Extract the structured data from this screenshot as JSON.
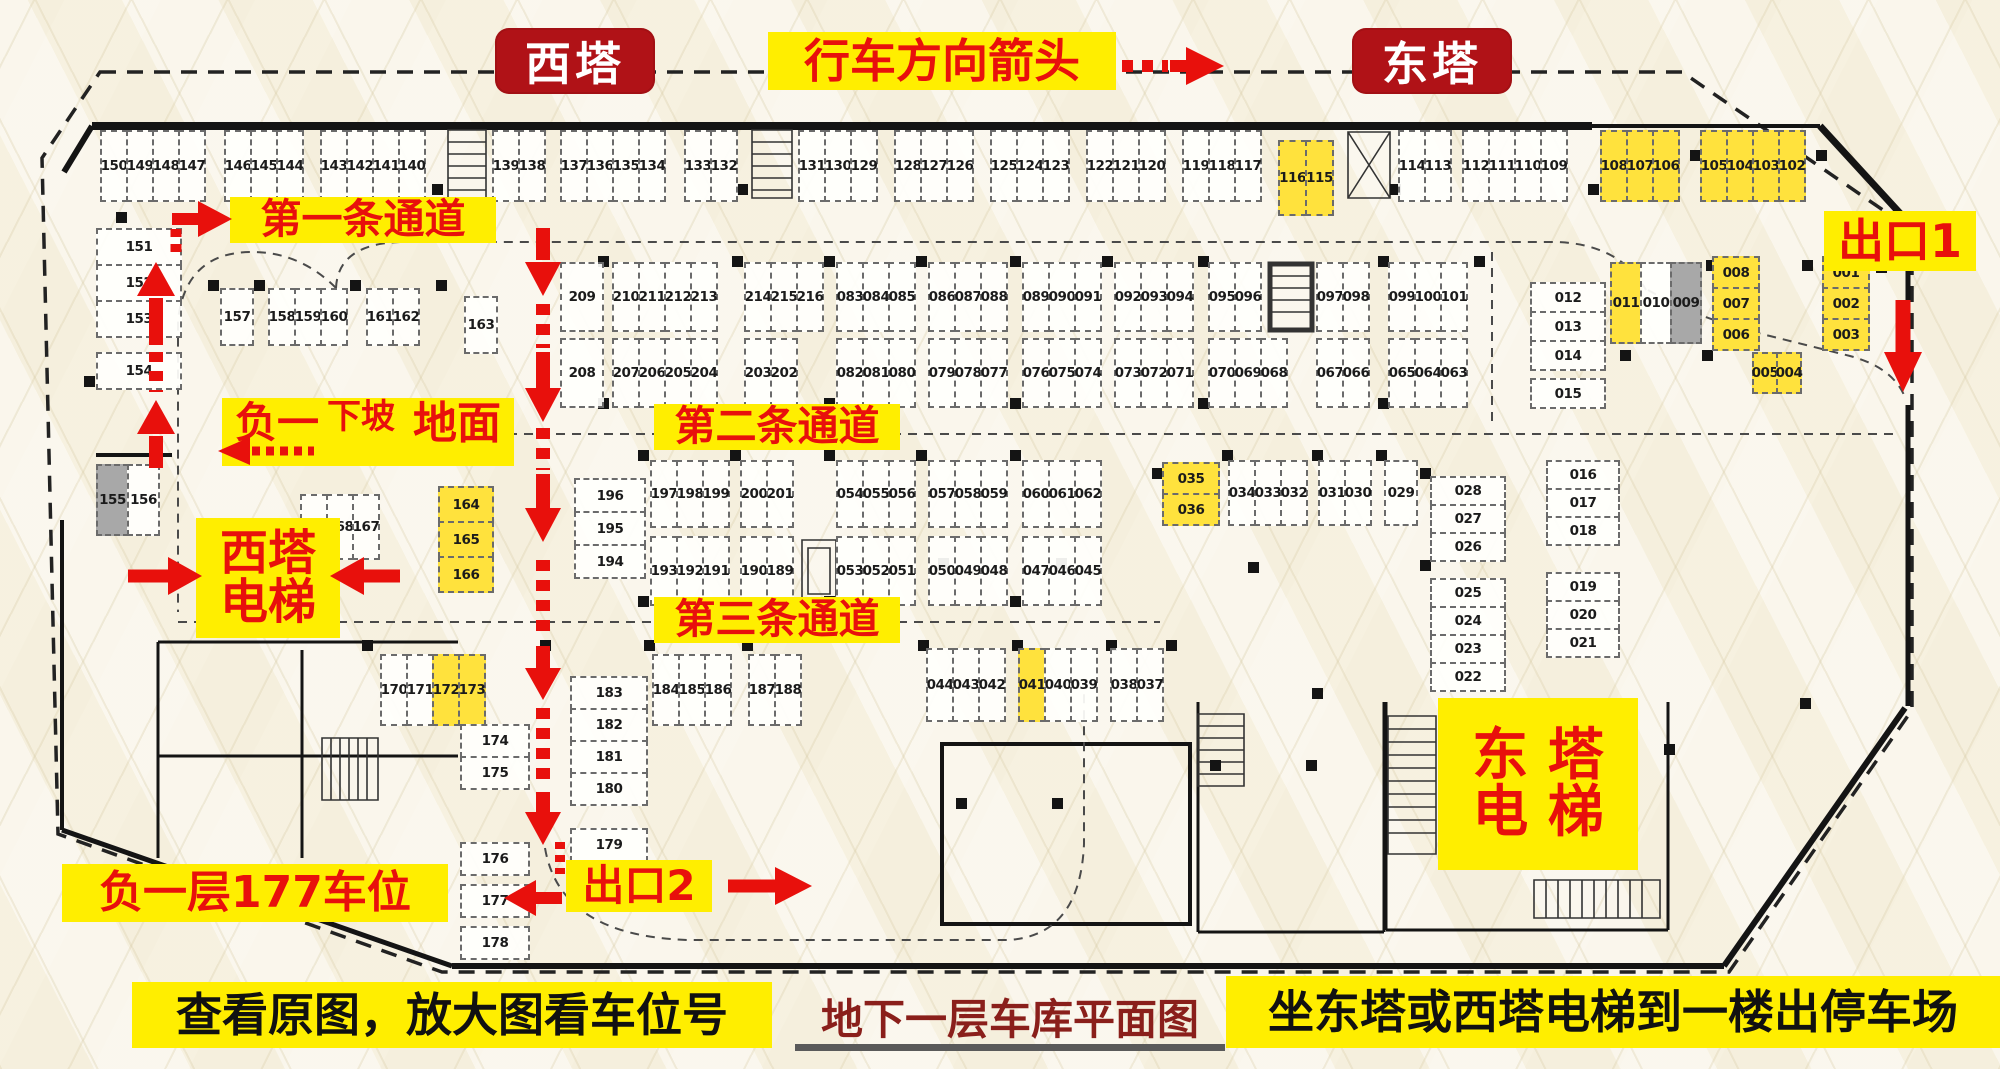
{
  "header": {
    "west_tower": "西塔",
    "direction": "行车方向箭头",
    "east_tower": "东塔"
  },
  "annotations": {
    "lane1": "第一条通道",
    "lane2": "第二条通道",
    "lane3": "第三条通道",
    "slope_b1": "负一",
    "slope_down": "下坡",
    "slope_ground": "地面",
    "west_elevator_line1": "西塔",
    "west_elevator_line2": "电梯",
    "east_elevator_line1": "东 塔",
    "east_elevator_line2": "电 梯",
    "exit1": "出口1",
    "exit2": "出口2",
    "b1_capacity": "负一层177车位"
  },
  "captions": {
    "left": "查看原图，放大图看车位号",
    "center": "地下一层车库平面图",
    "right": "坐东塔或西塔电梯到一楼出停车场"
  },
  "colors": {
    "badge_red": "#b01217",
    "label_yellow": "#ffee00",
    "arrow_red": "#e8100c",
    "spot_yellow": "#ffe23d",
    "spot_gray": "#a8a8a8",
    "caption_maroon": "#8a1f1b"
  },
  "plan": {
    "groups": [
      {
        "id": "tA",
        "spots": [
          "150",
          "149",
          "148",
          "147"
        ]
      },
      {
        "id": "tB",
        "spots": [
          "146",
          "145",
          "144"
        ]
      },
      {
        "id": "tC",
        "spots": [
          "143",
          "142",
          "141",
          "140"
        ]
      },
      {
        "id": "tD",
        "spots": [
          "139",
          "138"
        ]
      },
      {
        "id": "tE",
        "spots": [
          "137",
          "136",
          "135",
          "134"
        ]
      },
      {
        "id": "tF",
        "spots": [
          "133",
          "132"
        ]
      },
      {
        "id": "tG",
        "spots": [
          "131",
          "130",
          "129"
        ]
      },
      {
        "id": "tH",
        "spots": [
          "128",
          "127",
          "126"
        ]
      },
      {
        "id": "tI",
        "spots": [
          "125",
          "124",
          "123"
        ]
      },
      {
        "id": "tJ",
        "spots": [
          "122",
          "121",
          "120"
        ]
      },
      {
        "id": "tK",
        "spots": [
          "119",
          "118",
          "117"
        ]
      },
      {
        "id": "tL",
        "spots": [
          {
            "n": "116",
            "c": "y"
          },
          {
            "n": "115",
            "c": "y"
          }
        ]
      },
      {
        "id": "tM",
        "spots": [
          "114",
          "113"
        ]
      },
      {
        "id": "tN",
        "spots": [
          "112",
          "111",
          "110",
          "109"
        ]
      },
      {
        "id": "tO",
        "spots": [
          {
            "n": "108",
            "c": "y"
          },
          {
            "n": "107",
            "c": "y"
          },
          {
            "n": "106",
            "c": "y"
          }
        ]
      },
      {
        "id": "tP",
        "spots": [
          {
            "n": "105",
            "c": "y"
          },
          {
            "n": "104",
            "c": "y"
          },
          {
            "n": "103",
            "c": "y"
          },
          {
            "n": "102",
            "c": "y"
          }
        ]
      },
      {
        "id": "lA",
        "spots": [
          "151",
          "152",
          "153"
        ]
      },
      {
        "id": "lB",
        "spots": [
          "154"
        ]
      },
      {
        "id": "r2a",
        "spots": [
          "157"
        ]
      },
      {
        "id": "r2b",
        "spots": [
          "158",
          "159",
          "160"
        ]
      },
      {
        "id": "r2c",
        "spots": [
          "161",
          "162"
        ]
      },
      {
        "id": "r2d",
        "spots": [
          "163"
        ]
      },
      {
        "id": "r3a",
        "spots": [
          "209"
        ]
      },
      {
        "id": "r3b",
        "spots": [
          "210",
          "211",
          "212",
          "213"
        ]
      },
      {
        "id": "r3c",
        "spots": [
          "214",
          "215",
          "216"
        ]
      },
      {
        "id": "r3d",
        "spots": [
          "083",
          "084",
          "085"
        ]
      },
      {
        "id": "r3e",
        "spots": [
          "086",
          "087",
          "088"
        ]
      },
      {
        "id": "r3f",
        "spots": [
          "089",
          "090",
          "091"
        ]
      },
      {
        "id": "r3g",
        "spots": [
          "092",
          "093",
          "094"
        ]
      },
      {
        "id": "r3h",
        "spots": [
          "095",
          "096"
        ]
      },
      {
        "id": "r3i",
        "spots": [
          "097",
          "098"
        ]
      },
      {
        "id": "r3j",
        "spots": [
          "099",
          "100",
          "101"
        ]
      },
      {
        "id": "r3k",
        "spots": [
          "208"
        ]
      },
      {
        "id": "r3l",
        "spots": [
          "207",
          "206",
          "205",
          "204"
        ]
      },
      {
        "id": "r3m",
        "spots": [
          "203",
          "202"
        ]
      },
      {
        "id": "r3n",
        "spots": [
          "082",
          "081",
          "080"
        ]
      },
      {
        "id": "r3o",
        "spots": [
          "079",
          "078",
          "077"
        ]
      },
      {
        "id": "r3p",
        "spots": [
          "076",
          "075",
          "074"
        ]
      },
      {
        "id": "r3q",
        "spots": [
          "073",
          "072",
          "071"
        ]
      },
      {
        "id": "r3r",
        "spots": [
          "070",
          "069",
          "068"
        ]
      },
      {
        "id": "r3s",
        "spots": [
          "067",
          "066"
        ]
      },
      {
        "id": "r3t",
        "spots": [
          "065",
          "064",
          "063"
        ]
      },
      {
        "id": "rcA",
        "spots": [
          "012",
          "013",
          "014"
        ]
      },
      {
        "id": "rcB",
        "spots": [
          "015"
        ]
      },
      {
        "id": "rcC",
        "spots": [
          {
            "n": "011",
            "c": "y"
          },
          "010",
          {
            "n": "009",
            "c": "g"
          }
        ]
      },
      {
        "id": "rcD",
        "spots": [
          {
            "n": "008",
            "c": "y"
          },
          {
            "n": "007",
            "c": "y"
          },
          {
            "n": "006",
            "c": "y"
          }
        ]
      },
      {
        "id": "rcE",
        "spots": [
          {
            "n": "001",
            "c": "y"
          },
          {
            "n": "002",
            "c": "y"
          },
          {
            "n": "003",
            "c": "y"
          }
        ]
      },
      {
        "id": "rcF",
        "spots": [
          {
            "n": "005",
            "c": "y"
          },
          {
            "n": "004",
            "c": "y"
          }
        ]
      },
      {
        "id": "mA",
        "spots": [
          {
            "n": "155",
            "c": "g"
          },
          "156"
        ]
      },
      {
        "id": "mB",
        "spots": [
          "169",
          "168",
          "167"
        ]
      },
      {
        "id": "mC",
        "spots": [
          {
            "n": "164",
            "c": "y"
          },
          {
            "n": "165",
            "c": "y"
          },
          {
            "n": "166",
            "c": "y"
          }
        ]
      },
      {
        "id": "m196",
        "spots": [
          "196",
          "195",
          "194"
        ]
      },
      {
        "id": "r4a",
        "spots": [
          "197",
          "198",
          "199"
        ]
      },
      {
        "id": "r4b",
        "spots": [
          "200",
          "201"
        ]
      },
      {
        "id": "r4c",
        "spots": [
          "054",
          "055",
          "056"
        ]
      },
      {
        "id": "r4d",
        "spots": [
          "057",
          "058",
          "059"
        ]
      },
      {
        "id": "r4e",
        "spots": [
          "060",
          "061",
          "062"
        ]
      },
      {
        "id": "r4f",
        "spots": [
          "193",
          "192",
          "191"
        ]
      },
      {
        "id": "r4g",
        "spots": [
          "190",
          "189"
        ]
      },
      {
        "id": "r4h",
        "spots": [
          "053",
          "052",
          "051"
        ]
      },
      {
        "id": "r4i",
        "spots": [
          "050",
          "049",
          "048"
        ]
      },
      {
        "id": "r4j",
        "spots": [
          "047",
          "046",
          "045"
        ]
      },
      {
        "id": "m35",
        "spots": [
          {
            "n": "035",
            "c": "y"
          },
          {
            "n": "036",
            "c": "y"
          }
        ]
      },
      {
        "id": "r4k",
        "spots": [
          "034",
          "033",
          "032"
        ]
      },
      {
        "id": "r4l",
        "spots": [
          "031",
          "030"
        ]
      },
      {
        "id": "r4m",
        "spots": [
          "029"
        ]
      },
      {
        "id": "rcG",
        "spots": [
          "028",
          "027",
          "026"
        ]
      },
      {
        "id": "rcH",
        "spots": [
          "025",
          "024",
          "023",
          "022"
        ]
      },
      {
        "id": "rcJ",
        "spots": [
          "016",
          "017",
          "018"
        ]
      },
      {
        "id": "rcK",
        "spots": [
          "019",
          "020",
          "021"
        ]
      },
      {
        "id": "bA",
        "spots": [
          "170",
          "171",
          {
            "n": "172",
            "c": "y"
          },
          {
            "n": "173",
            "c": "y"
          }
        ]
      },
      {
        "id": "bB",
        "spots": [
          "174",
          "175"
        ]
      },
      {
        "id": "bC",
        "spots": [
          "176"
        ]
      },
      {
        "id": "bD",
        "spots": [
          "177"
        ]
      },
      {
        "id": "bE",
        "spots": [
          "178"
        ]
      },
      {
        "id": "bF",
        "spots": [
          "183",
          "182",
          "181",
          "180"
        ]
      },
      {
        "id": "bG",
        "spots": [
          "179"
        ]
      },
      {
        "id": "bH",
        "spots": [
          "184",
          "185",
          "186"
        ]
      },
      {
        "id": "bI",
        "spots": [
          "187",
          "188"
        ]
      },
      {
        "id": "bJ",
        "spots": [
          "044",
          "043",
          "042"
        ]
      },
      {
        "id": "bK",
        "spots": [
          {
            "n": "041",
            "c": "y"
          },
          "040",
          "039"
        ]
      },
      {
        "id": "bL",
        "spots": [
          "038",
          "037"
        ]
      }
    ]
  }
}
